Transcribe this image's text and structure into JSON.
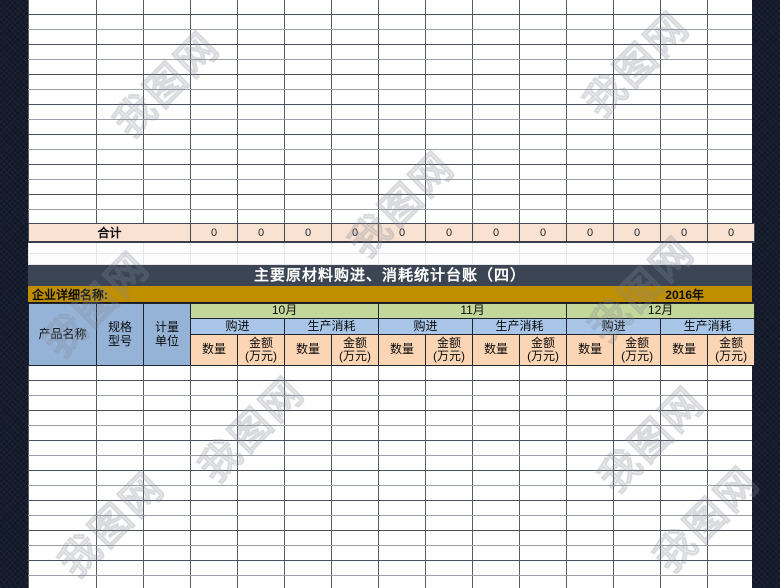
{
  "page": {
    "watermark_text": "我图网"
  },
  "summary_sheet": {
    "total_label": "合计",
    "total_values": [
      "0",
      "0",
      "0",
      "0",
      "0",
      "0",
      "0",
      "0",
      "0",
      "0",
      "0",
      "0"
    ]
  },
  "ledger": {
    "title": "主要原材料购进、消耗统计台账（四）",
    "company_name_label": "企业详细名称:",
    "year": "2016年",
    "left_columns": [
      "产品名称",
      "规格\n型号",
      "计量\n单位"
    ],
    "months": [
      "10月",
      "11月",
      "12月"
    ],
    "purchase_label": "购进",
    "consumption_label": "生产消耗",
    "quantity_label": "数量",
    "amount_label": "金额\n(万元)",
    "colors": {
      "title_bar": "#3B4553",
      "header_gold": "#BF8F00",
      "month_green": "#C4D79B",
      "subheader_blue": "#A9C6E8",
      "left_column_blue": "#95B3D7",
      "measure_peach": "#FBD5B4",
      "total_row_peach": "#F9E2D2"
    }
  }
}
